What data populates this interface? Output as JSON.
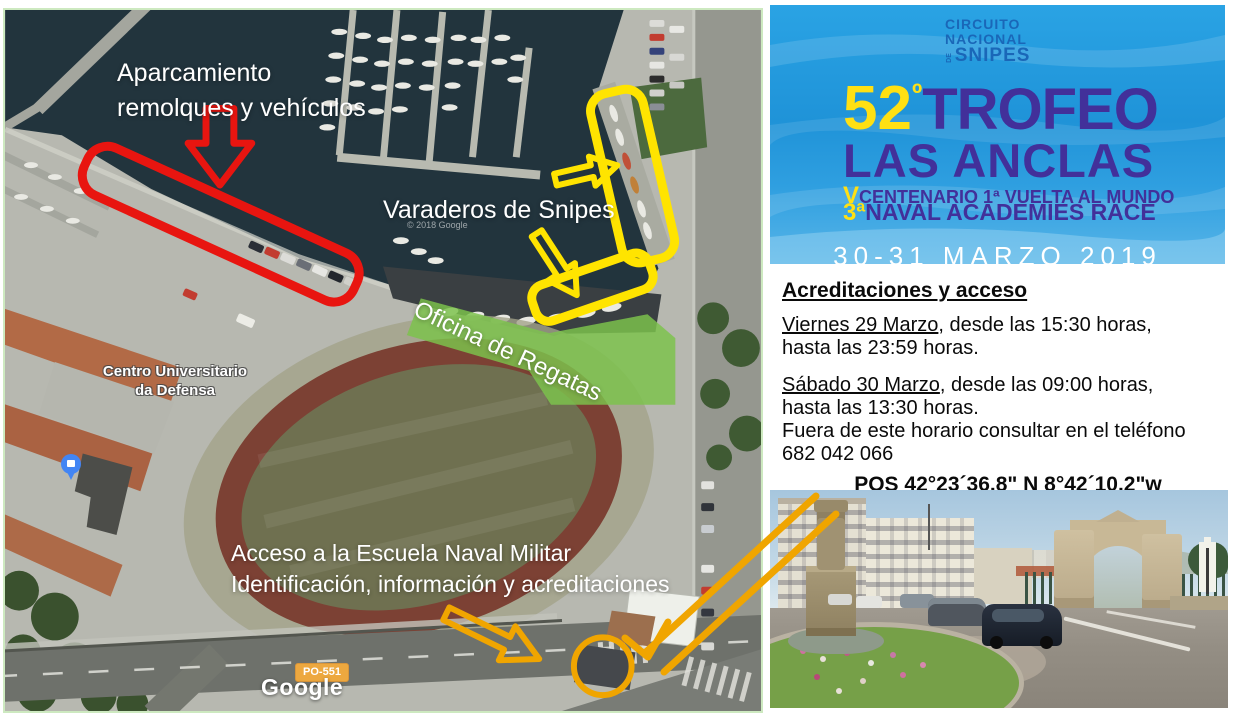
{
  "colors": {
    "highlight_red": "#e81510",
    "highlight_yellow": "#ffe400",
    "highlight_orange": "#f0a500",
    "overlay_green": "#7cc24c",
    "poster_purple": "#42309a",
    "poster_yellow": "#ffe013"
  },
  "map": {
    "annotations": {
      "parking_line1": "Aparcamiento",
      "parking_line2": "remolques y vehículos",
      "varaderos": "Varaderos de Snipes",
      "oficina": "Oficina de Regatas",
      "acceso_line1": "Acceso a la Escuela Naval Militar",
      "acceso_line2": "Identificación, información y acreditaciones"
    },
    "place_labels": {
      "centro_line1": "Centro Universitario",
      "centro_line2": "da Defensa",
      "road_badge": "PO-551",
      "google_logo": "Google",
      "copyright": "© 2018 Google"
    }
  },
  "poster": {
    "logo": {
      "line1": "CIRCUITO",
      "line2": "NACIONAL",
      "de": "DE",
      "line3": "SNIPES"
    },
    "edition_number": "52",
    "edition_ordinal": "º",
    "title_line1": "TROFEO",
    "title_line2": "LAS ANCLAS",
    "subtitle1_prefix": "V",
    "subtitle1": "CENTENARIO 1ª VUELTA AL MUNDO",
    "subtitle2_prefix": "3ª",
    "subtitle2": "NAVAL ACADEMIES RACE",
    "dates": "30-31 MARZO 2019"
  },
  "info": {
    "heading": "Acreditaciones y acceso",
    "friday_date": "Viernes 29 Marzo",
    "friday_rest": ", desde las 15:30 horas,",
    "friday_line2": "hasta las 23:59 horas.",
    "saturday_date": "Sábado 30 Marzo",
    "saturday_rest": ", desde las 09:00 horas,",
    "saturday_line2": "hasta las 13:30 horas.",
    "phone_line1": "Fuera de este horario consultar en el teléfono",
    "phone_line2": "682 042 066",
    "pos": "POS 42°23´36.8\" N 8°42´10.2\"w"
  }
}
